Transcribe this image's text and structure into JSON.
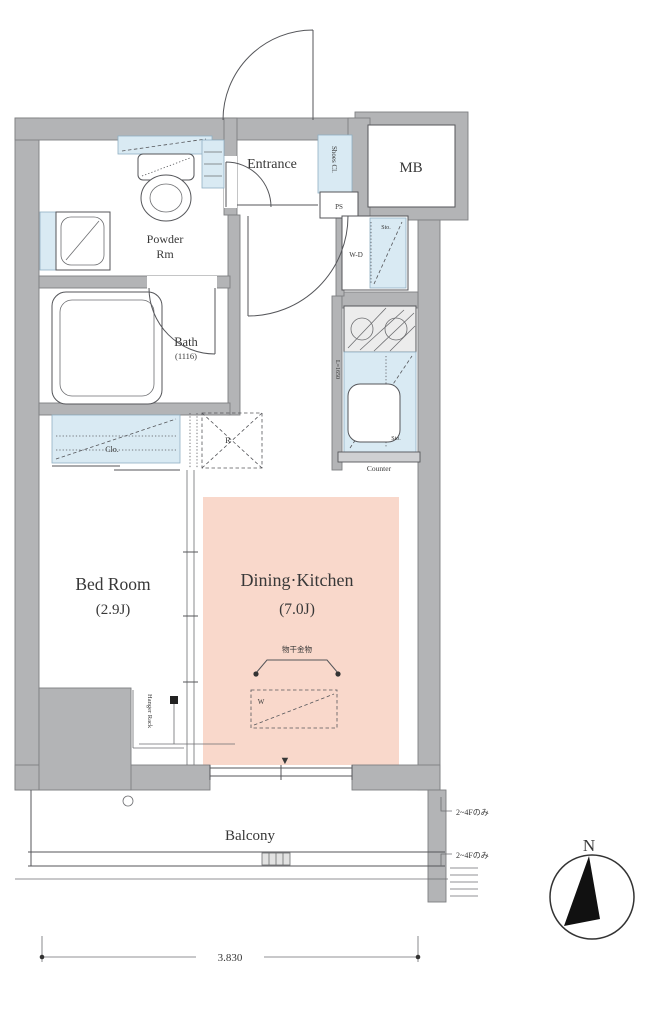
{
  "floorplan": {
    "rooms": {
      "entrance": "Entrance",
      "mb": "MB",
      "powder1": "Powder",
      "powder2": "Rm",
      "bath": "Bath",
      "bath_size": "(1116)",
      "bedroom": "Bed Room",
      "bedroom_size": "(2.9J)",
      "dk": "Dining·Kitchen",
      "dk_size": "(7.0J)",
      "balcony": "Balcony"
    },
    "fixtures": {
      "shoes": "Shoes Cl.",
      "ps": "PS",
      "wd": "W-D",
      "sto1": "Sto.",
      "sto2": "Sto.",
      "kitchen_len": "L=1650",
      "counter": "Counter",
      "clo": "Clo.",
      "fridge": "R",
      "washer": "W",
      "monohoshi": "物干金物",
      "hanger": "Hanger Rack"
    },
    "annotations": {
      "note1": "2~4Fのみ",
      "note2": "2~4Fのみ",
      "dim": "3.830",
      "north": "N",
      "marker": "▼"
    },
    "colors": {
      "wall": "#b3b4b6",
      "fixture_blue": "#d9eaf3",
      "dk_pink": "#f9d8cb",
      "line": "#55565a"
    }
  }
}
